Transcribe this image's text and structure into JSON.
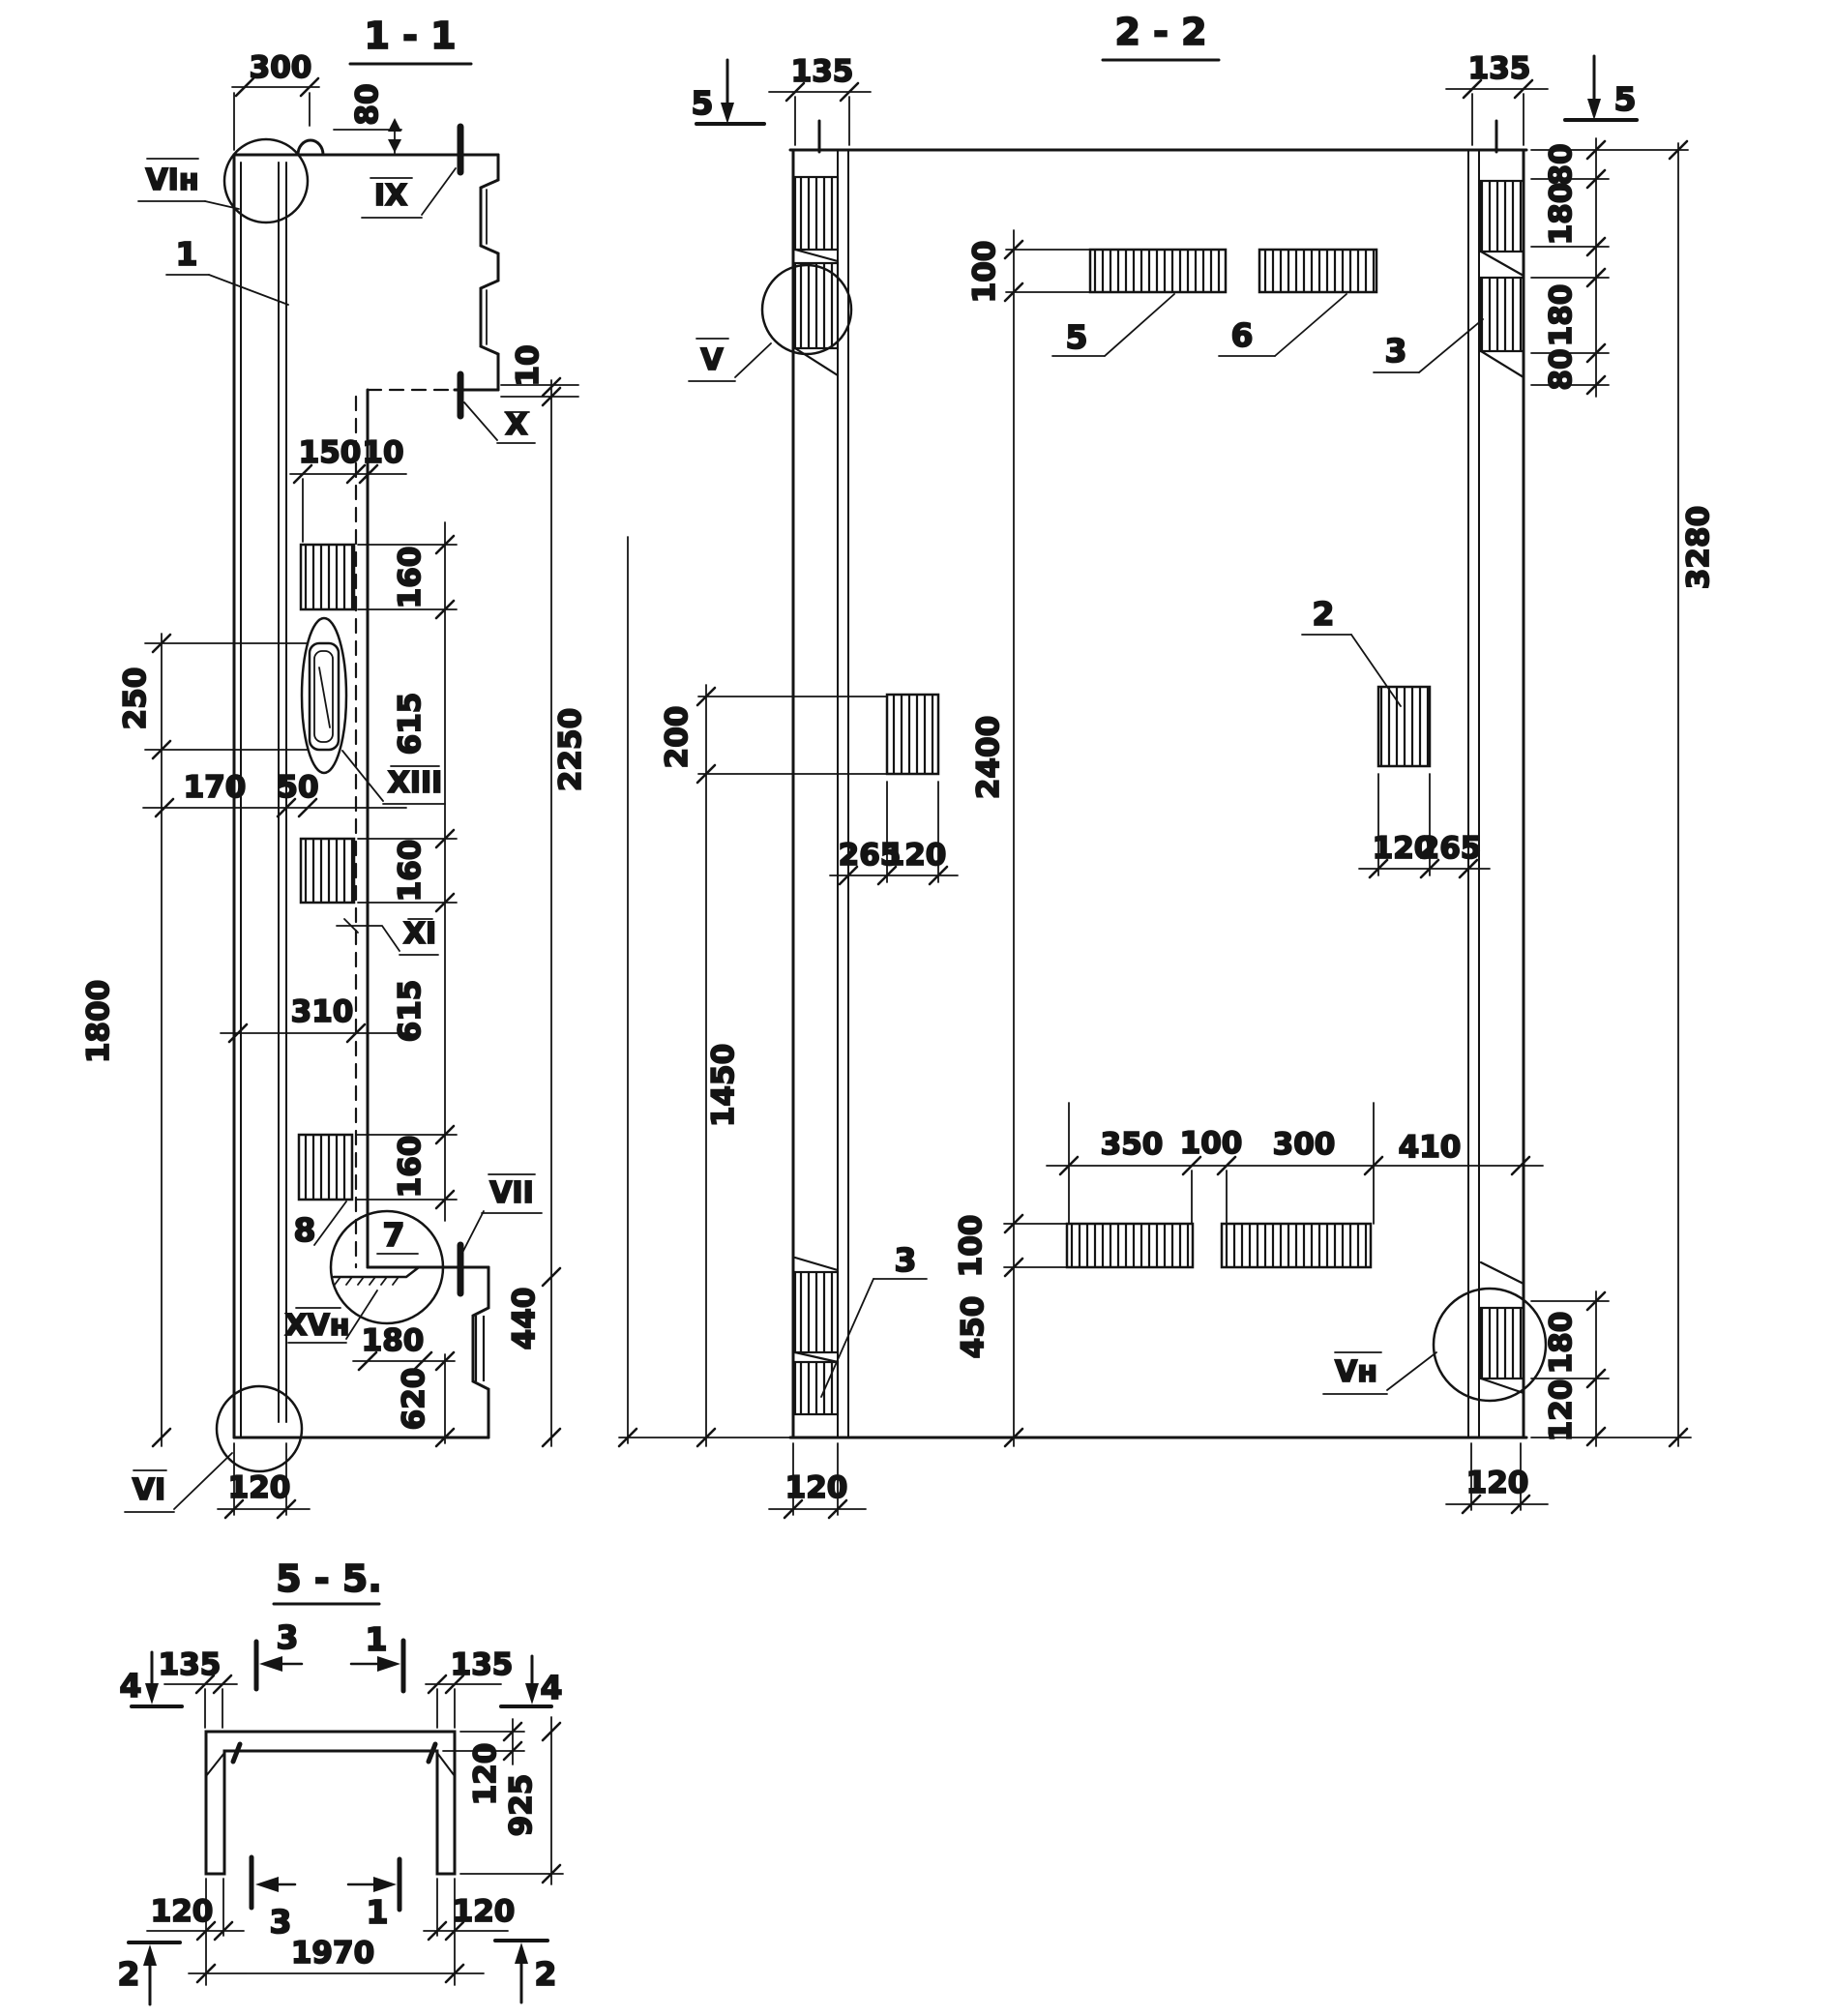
{
  "s11": {
    "title": "1 - 1",
    "d300": "300",
    "d80": "80",
    "d150": "150",
    "d10a": "10",
    "d10b": "10",
    "d160a": "160",
    "d615a": "615",
    "d160b": "160",
    "d615b": "615",
    "d160c": "160",
    "d250": "250",
    "d170": "170",
    "d50": "50",
    "d310": "310",
    "d1800": "1800",
    "d2250": "2250",
    "d440": "440",
    "d180": "180",
    "d620": "620",
    "d120": "120",
    "lVIn": "VIн",
    "lIX": "IX",
    "lX": "X",
    "lXIII": "XIII",
    "lXI": "XI",
    "lVII": "VII",
    "lXVn": "XVн",
    "lVI": "VI",
    "n1": "1",
    "n7": "7",
    "n8": "8"
  },
  "s22": {
    "title": "2 - 2",
    "m5l": "5",
    "m5r": "5",
    "d135l": "135",
    "d135r": "135",
    "d80a": "80",
    "d180a": "180",
    "d180b": "180",
    "d80b": "80",
    "d3280": "3280",
    "d100t": "100",
    "n5": "5",
    "n6": "6",
    "n3t": "3",
    "n2": "2",
    "n3b": "3",
    "lV": "V",
    "lVn": "Vн",
    "d200": "200",
    "d2400": "2400",
    "d265l": "265",
    "d120l": "120",
    "d120r": "120",
    "d265r": "265",
    "d1450": "1450",
    "d100b": "100",
    "d450": "450",
    "d350": "350",
    "d100c": "100",
    "d300": "300",
    "d410": "410",
    "d180c": "180",
    "d120c": "120",
    "d120bl": "120",
    "d120br": "120"
  },
  "s55": {
    "title": "5 - 5.",
    "m3t": "3",
    "m1t": "1",
    "m4l": "4",
    "m4r": "4",
    "m3b": "3",
    "m1b": "1",
    "m2l": "2",
    "m2r": "2",
    "d135l": "135",
    "d135r": "135",
    "d120f": "120",
    "d925": "925",
    "d120bl": "120",
    "d120br": "120",
    "d1970": "1970"
  }
}
